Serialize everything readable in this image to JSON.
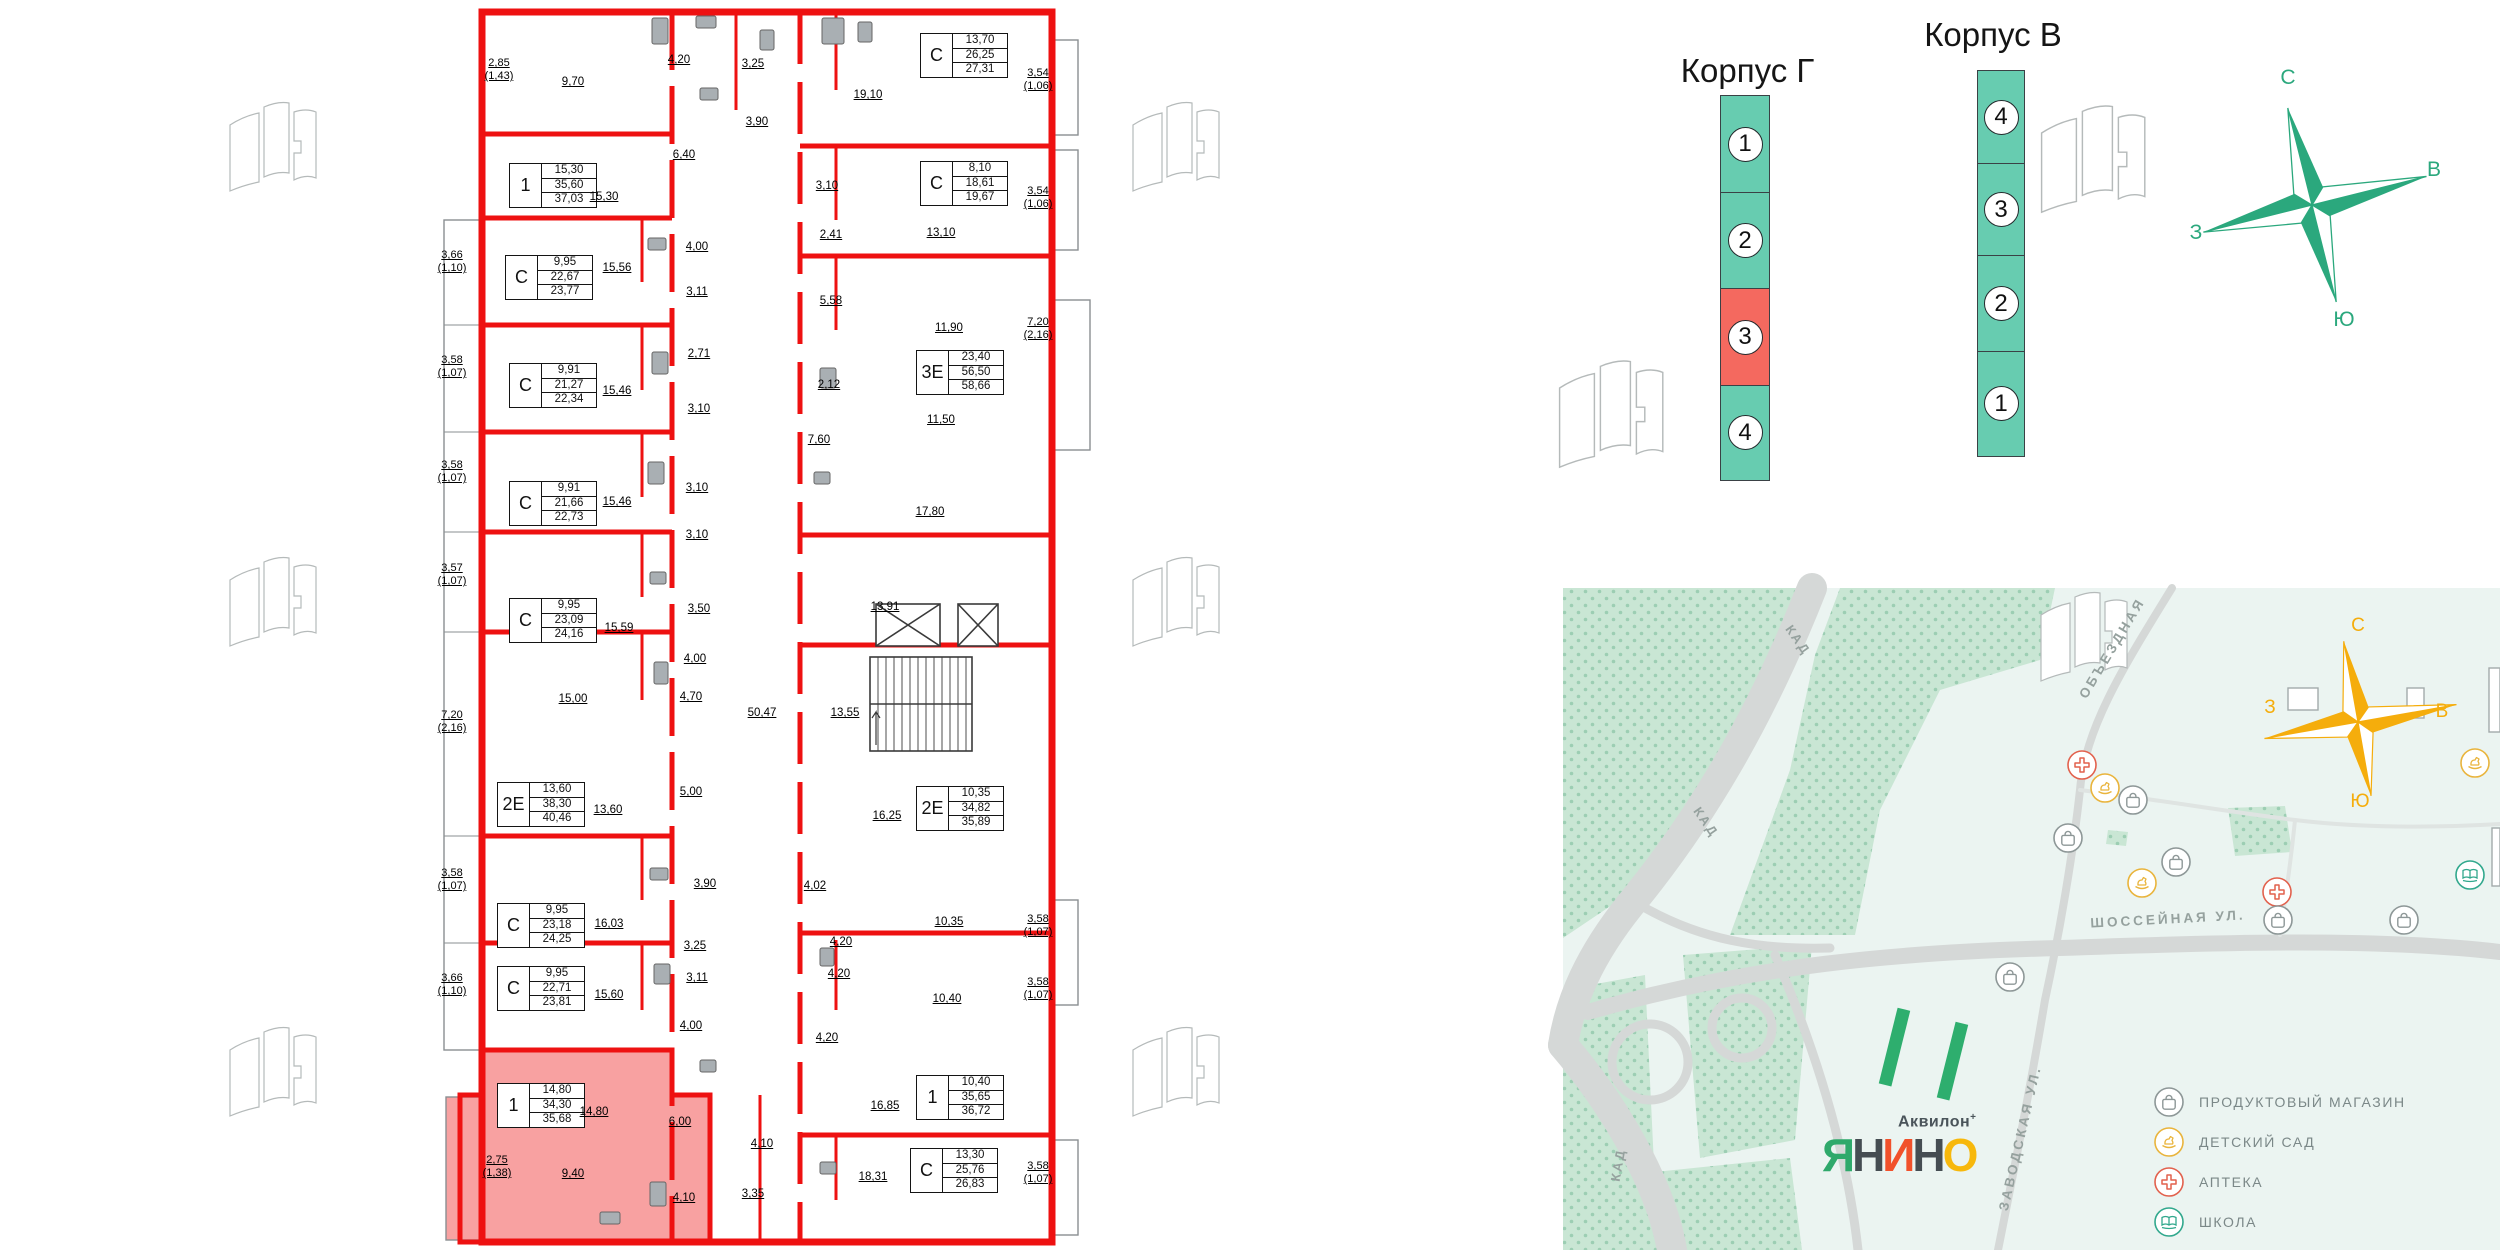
{
  "colors": {
    "wall_red": "#EE1111",
    "unit_highlight": "#F8A1A1",
    "section_teal": "#67CCB0",
    "section_red": "#F4695F",
    "compass_green": "#2BA87D",
    "compass_yellow": "#F5AD0C",
    "map_bg": "#EBF4F1",
    "forest": "#C9E6D4",
    "road_gray": "#D5D8D7",
    "street_text": "#95A19E",
    "legend_text": "#7B8888",
    "poi_shop": "#8D9797",
    "poi_kindergarten": "#E9B43C",
    "poi_pharmacy": "#E2614D",
    "poi_school": "#31A88D"
  },
  "sections": {
    "korpus_g": {
      "title": "Корпус Г",
      "items": [
        {
          "n": "1"
        },
        {
          "n": "2"
        },
        {
          "n": "3",
          "selected": true
        },
        {
          "n": "4"
        }
      ]
    },
    "korpus_v": {
      "title": "Корпус В",
      "items": [
        {
          "n": "4"
        },
        {
          "n": "3"
        },
        {
          "n": "2"
        },
        {
          "n": "1"
        }
      ]
    }
  },
  "compass": {
    "north": "С",
    "east": "В",
    "south": "Ю",
    "west": "З"
  },
  "plan": {
    "units": [
      {
        "type": "1",
        "rows": [
          "15,30",
          "35,60",
          "37,03"
        ],
        "x": 509,
        "y": 163
      },
      {
        "type": "С",
        "rows": [
          "9,95",
          "22,67",
          "23,77"
        ],
        "x": 505,
        "y": 255
      },
      {
        "type": "С",
        "rows": [
          "9,91",
          "21,27",
          "22,34"
        ],
        "x": 509,
        "y": 363
      },
      {
        "type": "С",
        "rows": [
          "9,91",
          "21,66",
          "22,73"
        ],
        "x": 509,
        "y": 481
      },
      {
        "type": "С",
        "rows": [
          "9,95",
          "23,09",
          "24,16"
        ],
        "x": 509,
        "y": 598
      },
      {
        "type": "2Е",
        "rows": [
          "13,60",
          "38,30",
          "40,46"
        ],
        "x": 497,
        "y": 782
      },
      {
        "type": "С",
        "rows": [
          "9,95",
          "23,18",
          "24,25"
        ],
        "x": 497,
        "y": 903
      },
      {
        "type": "С",
        "rows": [
          "9,95",
          "22,71",
          "23,81"
        ],
        "x": 497,
        "y": 966
      },
      {
        "type": "1",
        "rows": [
          "14,80",
          "34,30",
          "35,68"
        ],
        "x": 497,
        "y": 1083,
        "highlight": true
      },
      {
        "type": "С",
        "rows": [
          "13,70",
          "26,25",
          "27,31"
        ],
        "x": 920,
        "y": 33
      },
      {
        "type": "С",
        "rows": [
          "8,10",
          "18,61",
          "19,67"
        ],
        "x": 920,
        "y": 161
      },
      {
        "type": "3Е",
        "rows": [
          "23,40",
          "56,50",
          "58,66"
        ],
        "x": 916,
        "y": 350
      },
      {
        "type": "2Е",
        "rows": [
          "10,35",
          "34,82",
          "35,89"
        ],
        "x": 916,
        "y": 786
      },
      {
        "type": "1",
        "rows": [
          "10,40",
          "35,65",
          "36,72"
        ],
        "x": 916,
        "y": 1075
      },
      {
        "type": "С",
        "rows": [
          "13,30",
          "25,76",
          "26,83"
        ],
        "x": 910,
        "y": 1148
      }
    ],
    "rooms": [
      {
        "t": "9,70",
        "x": 573,
        "y": 82
      },
      {
        "t": "4,20",
        "x": 679,
        "y": 60
      },
      {
        "t": "3,25",
        "x": 753,
        "y": 64
      },
      {
        "t": "19,10",
        "x": 868,
        "y": 95
      },
      {
        "t": "3,90",
        "x": 757,
        "y": 122
      },
      {
        "t": "6,40",
        "x": 684,
        "y": 155
      },
      {
        "t": "15,30",
        "x": 604,
        "y": 197
      },
      {
        "t": "3,10",
        "x": 827,
        "y": 186
      },
      {
        "t": "13,10",
        "x": 941,
        "y": 233
      },
      {
        "t": "2,41",
        "x": 831,
        "y": 235
      },
      {
        "t": "5,58",
        "x": 831,
        "y": 301
      },
      {
        "t": "11,90",
        "x": 949,
        "y": 328
      },
      {
        "t": "15,56",
        "x": 617,
        "y": 268
      },
      {
        "t": "4,00",
        "x": 697,
        "y": 247
      },
      {
        "t": "3,11",
        "x": 697,
        "y": 292
      },
      {
        "t": "2,71",
        "x": 699,
        "y": 354
      },
      {
        "t": "15,46",
        "x": 617,
        "y": 391
      },
      {
        "t": "3,10",
        "x": 699,
        "y": 409
      },
      {
        "t": "2,12",
        "x": 829,
        "y": 385
      },
      {
        "t": "7,60",
        "x": 819,
        "y": 440
      },
      {
        "t": "11,50",
        "x": 941,
        "y": 420
      },
      {
        "t": "15,46",
        "x": 617,
        "y": 502
      },
      {
        "t": "3,10",
        "x": 697,
        "y": 488
      },
      {
        "t": "3,10",
        "x": 697,
        "y": 535
      },
      {
        "t": "17,80",
        "x": 930,
        "y": 512
      },
      {
        "t": "15,59",
        "x": 619,
        "y": 628
      },
      {
        "t": "3,50",
        "x": 699,
        "y": 609
      },
      {
        "t": "13,91",
        "x": 885,
        "y": 607
      },
      {
        "t": "4,00",
        "x": 695,
        "y": 659
      },
      {
        "t": "15,00",
        "x": 573,
        "y": 699
      },
      {
        "t": "4,70",
        "x": 691,
        "y": 697
      },
      {
        "t": "50,47",
        "x": 762,
        "y": 713
      },
      {
        "t": "13,55",
        "x": 845,
        "y": 713
      },
      {
        "t": "5,00",
        "x": 691,
        "y": 792
      },
      {
        "t": "13,60",
        "x": 608,
        "y": 810
      },
      {
        "t": "16,25",
        "x": 887,
        "y": 816
      },
      {
        "t": "3,90",
        "x": 705,
        "y": 884
      },
      {
        "t": "4,02",
        "x": 815,
        "y": 886
      },
      {
        "t": "10,35",
        "x": 949,
        "y": 922
      },
      {
        "t": "16,03",
        "x": 609,
        "y": 924
      },
      {
        "t": "3,25",
        "x": 695,
        "y": 946
      },
      {
        "t": "4,20",
        "x": 841,
        "y": 942
      },
      {
        "t": "15,60",
        "x": 609,
        "y": 995
      },
      {
        "t": "3,11",
        "x": 697,
        "y": 978
      },
      {
        "t": "4,00",
        "x": 691,
        "y": 1026
      },
      {
        "t": "4,20",
        "x": 839,
        "y": 974
      },
      {
        "t": "10,40",
        "x": 947,
        "y": 999
      },
      {
        "t": "4,20",
        "x": 827,
        "y": 1038
      },
      {
        "t": "14,80",
        "x": 594,
        "y": 1112
      },
      {
        "t": "16,85",
        "x": 885,
        "y": 1106
      },
      {
        "t": "6,00",
        "x": 680,
        "y": 1122
      },
      {
        "t": "4,10",
        "x": 762,
        "y": 1144
      },
      {
        "t": "9,40",
        "x": 573,
        "y": 1174
      },
      {
        "t": "4,10",
        "x": 684,
        "y": 1198
      },
      {
        "t": "3,35",
        "x": 753,
        "y": 1194
      },
      {
        "t": "18,31",
        "x": 873,
        "y": 1177
      }
    ],
    "dims": [
      {
        "a": "2,85",
        "b": "(1,43)",
        "x": 499,
        "y": 70
      },
      {
        "a": "3,66",
        "b": "(1,10)",
        "x": 452,
        "y": 262
      },
      {
        "a": "3,58",
        "b": "(1,07)",
        "x": 452,
        "y": 367
      },
      {
        "a": "3,58",
        "b": "(1,07)",
        "x": 452,
        "y": 472
      },
      {
        "a": "3,57",
        "b": "(1,07)",
        "x": 452,
        "y": 575
      },
      {
        "a": "7,20",
        "b": "(2,16)",
        "x": 452,
        "y": 722
      },
      {
        "a": "3,58",
        "b": "(1,07)",
        "x": 452,
        "y": 880
      },
      {
        "a": "3,66",
        "b": "(1,10)",
        "x": 452,
        "y": 985
      },
      {
        "a": "2,75",
        "b": "(1,38)",
        "x": 497,
        "y": 1167
      },
      {
        "a": "3,54",
        "b": "(1,06)",
        "x": 1038,
        "y": 80
      },
      {
        "a": "3,54",
        "b": "(1,06)",
        "x": 1038,
        "y": 198
      },
      {
        "a": "7,20",
        "b": "(2,16)",
        "x": 1038,
        "y": 329
      },
      {
        "a": "3,58",
        "b": "(1,07)",
        "x": 1038,
        "y": 926
      },
      {
        "a": "3,58",
        "b": "(1,07)",
        "x": 1038,
        "y": 989
      },
      {
        "a": "3,58",
        "b": "(1,07)",
        "x": 1038,
        "y": 1173
      }
    ]
  },
  "map": {
    "street_labels": [
      {
        "t": "КАД",
        "x": 1798,
        "y": 640,
        "rot": 55,
        "fs": 13,
        "ls": 2
      },
      {
        "t": "КАД",
        "x": 1706,
        "y": 822,
        "rot": 55,
        "fs": 13,
        "ls": 2
      },
      {
        "t": "КАД",
        "x": 1618,
        "y": 1165,
        "rot": -80,
        "fs": 13,
        "ls": 2
      },
      {
        "t": "ОБЪЕЗДНАЯ",
        "x": 2112,
        "y": 648,
        "rot": -59,
        "fs": 13.5,
        "ls": 3
      },
      {
        "t": "ШОССЕЙНАЯ УЛ.",
        "x": 2168,
        "y": 919,
        "rot": -3,
        "fs": 13.5,
        "ls": 3
      },
      {
        "t": "ЗАВОДСКАЯ УЛ.",
        "x": 2020,
        "y": 1138,
        "rot": -77,
        "fs": 13.5,
        "ls": 3
      }
    ],
    "pois": [
      {
        "icon": "pharmacy",
        "x": 2082,
        "y": 765
      },
      {
        "icon": "kindergarten",
        "x": 2105,
        "y": 788
      },
      {
        "icon": "shop",
        "x": 2133,
        "y": 800
      },
      {
        "icon": "shop",
        "x": 2068,
        "y": 838
      },
      {
        "icon": "shop",
        "x": 2176,
        "y": 862
      },
      {
        "icon": "kindergarten",
        "x": 2142,
        "y": 883
      },
      {
        "icon": "pharmacy",
        "x": 2277,
        "y": 892
      },
      {
        "icon": "shop",
        "x": 2278,
        "y": 920
      },
      {
        "icon": "shop",
        "x": 2404,
        "y": 920
      },
      {
        "icon": "shop",
        "x": 2010,
        "y": 977
      },
      {
        "icon": "kindergarten",
        "x": 2475,
        "y": 763
      },
      {
        "icon": "school",
        "x": 2470,
        "y": 875
      }
    ],
    "legend": [
      {
        "icon": "shop",
        "label": "ПРОДУКТОВЫЙ МАГАЗИН"
      },
      {
        "icon": "kindergarten",
        "label": "ДЕТСКИЙ САД"
      },
      {
        "icon": "pharmacy",
        "label": "АПТЕКА"
      },
      {
        "icon": "school",
        "label": "ШКОЛА"
      }
    ],
    "logo": {
      "brand": "Аквилон",
      "sup": "+",
      "letters": [
        {
          "ch": "Я",
          "c": "#2FA96B"
        },
        {
          "ch": "Н",
          "c": "#454D52"
        },
        {
          "ch": "И",
          "c": "#F1512B"
        },
        {
          "ch": "Н",
          "c": "#454D52"
        },
        {
          "ch": "О",
          "c": "#F7B80C"
        }
      ]
    }
  }
}
